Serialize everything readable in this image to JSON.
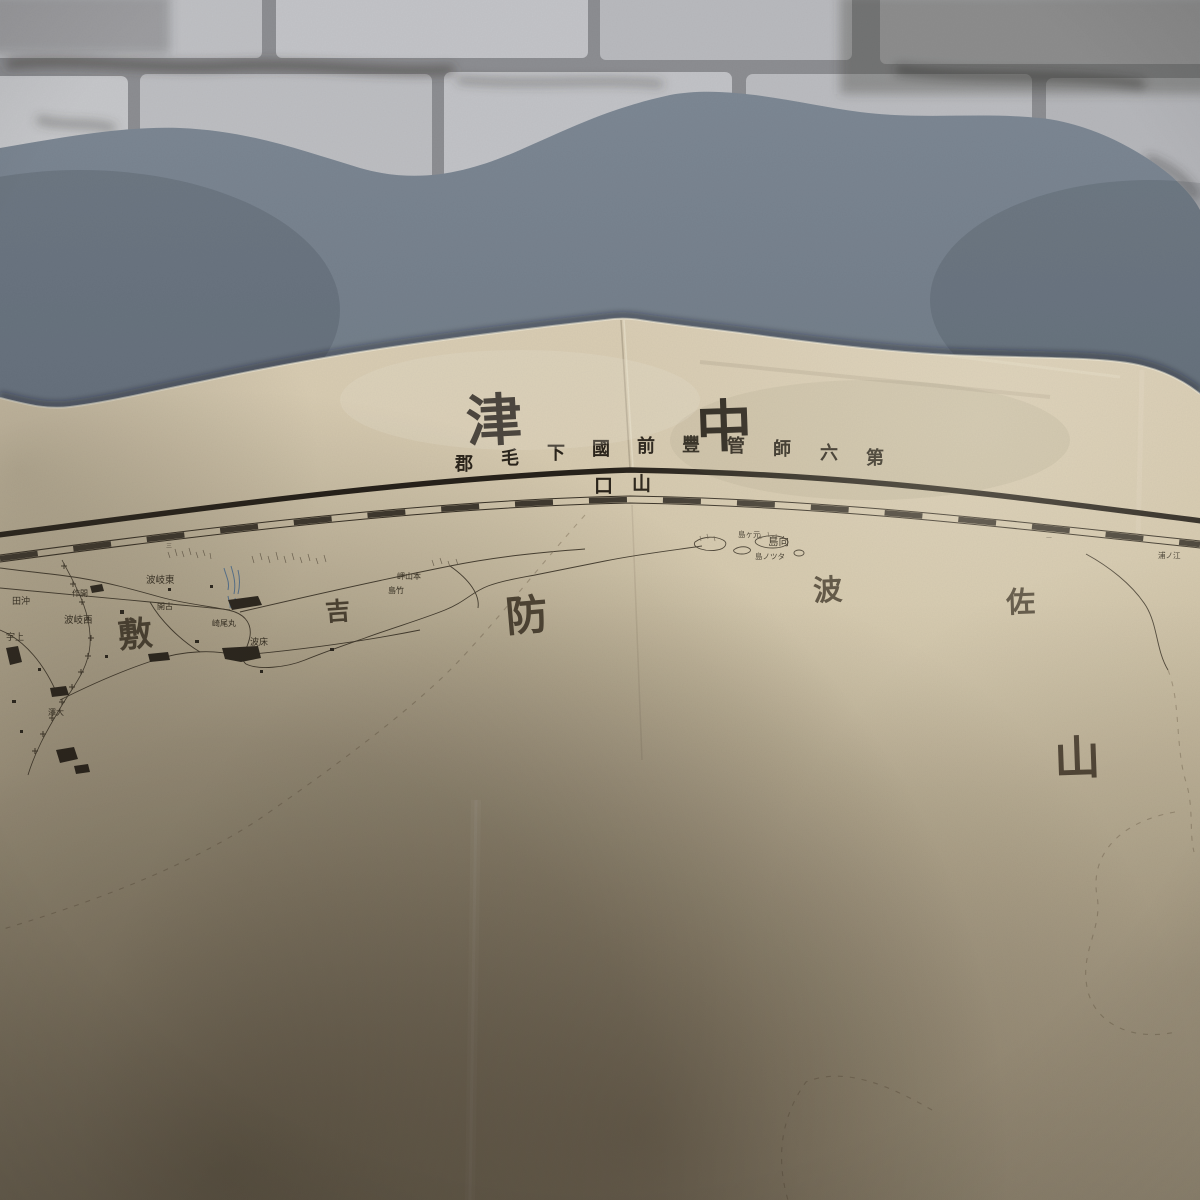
{
  "colors": {
    "wall_brick": "#bdbec2",
    "wall_mortar": "#8d8e92",
    "wall_smudge": "#4e4c47",
    "cloth_blue_gray": "#75808c",
    "paper_cream": "#d3c7ab",
    "paper_shadow": "#5f574a",
    "map_ink": "#2e2820",
    "faint_boundary_ink": "#8a7c64",
    "river_blue": "#4f79a6"
  },
  "map_sheet": {
    "title": {
      "text": "中津",
      "display_chars": [
        "津",
        "中"
      ]
    },
    "subtitle": {
      "text": "第六師管豐前國下毛郡",
      "display_chars": [
        "郡",
        "毛",
        "下",
        "國",
        "前",
        "豐",
        "管",
        "師",
        "六",
        "第"
      ]
    },
    "adjacent_sheet_label": {
      "text": "山口",
      "display_chars": [
        "口",
        "山"
      ]
    },
    "large_area_chars": [
      "敷",
      "吉",
      "防",
      "波",
      "佐",
      "山"
    ],
    "border_tick_labels": [
      "三",
      "二"
    ],
    "place_labels": [
      {
        "text": "波岐東",
        "reading": "東岐波"
      },
      {
        "text": "作開",
        "reading": "開作"
      },
      {
        "text": "波岐西",
        "reading": "西岐波"
      },
      {
        "text": "開古",
        "reading": "古開"
      },
      {
        "text": "崎尾丸",
        "reading": "丸尾崎"
      },
      {
        "text": "波床",
        "reading": "床波"
      },
      {
        "text": "岬山本",
        "reading": "本山岬"
      },
      {
        "text": "島竹",
        "reading": "竹島"
      },
      {
        "text": "島ヶ元",
        "reading": "元ヶ島"
      },
      {
        "text": "島向",
        "reading": "向島"
      },
      {
        "text": "島ノツタ",
        "reading": "タツノ島"
      },
      {
        "text": "浦ノ江",
        "reading": "江ノ浦"
      },
      {
        "text": "田沖",
        "reading": "沖田"
      },
      {
        "text": "宇上",
        "reading": "上宇"
      },
      {
        "text": "澤大",
        "reading": "大澤"
      }
    ]
  }
}
